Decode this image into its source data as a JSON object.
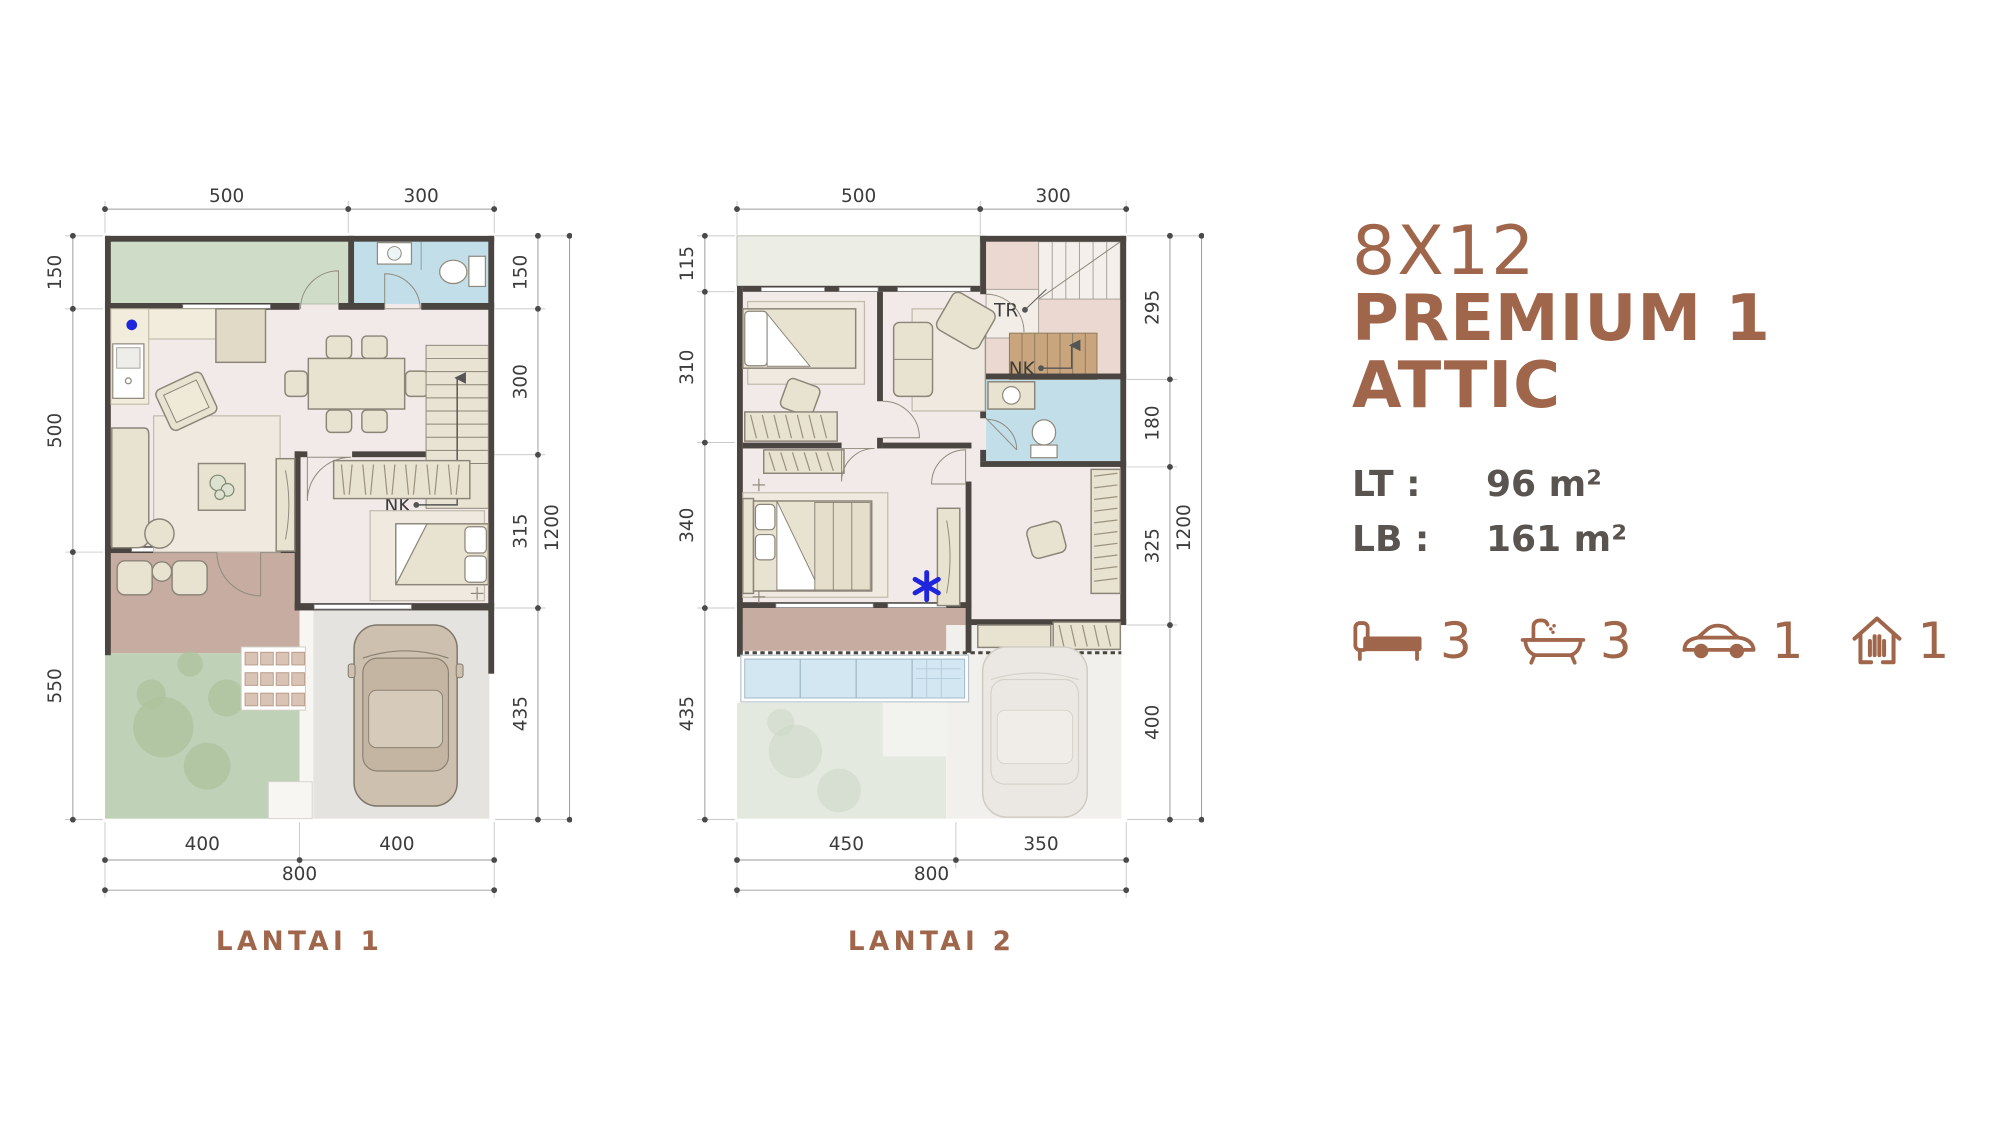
{
  "title": {
    "line1": "8X12",
    "line2": "PREMIUM 1 ATTIC"
  },
  "specs": {
    "rows": [
      {
        "label": "LT :",
        "value": "96 m²"
      },
      {
        "label": "LB :",
        "value": "161 m²"
      }
    ]
  },
  "features": {
    "items": [
      {
        "name": "bedrooms",
        "icon": "bed-icon",
        "count": "3"
      },
      {
        "name": "bathrooms",
        "icon": "bath-icon",
        "count": "3"
      },
      {
        "name": "carport",
        "icon": "car-icon",
        "count": "1"
      },
      {
        "name": "attic",
        "icon": "attic-icon",
        "count": "1"
      }
    ]
  },
  "floor1": {
    "label": "LANTAI 1",
    "dims": {
      "top": [
        "500",
        "300"
      ],
      "left": [
        "150",
        "500",
        "550"
      ],
      "right": [
        "150",
        "300",
        "315",
        "435"
      ],
      "right_total": "1200",
      "bottom": [
        "400",
        "400"
      ],
      "bottom_total": "800"
    },
    "annotations": {
      "stairs": "NK"
    }
  },
  "floor2": {
    "label": "LANTAI 2",
    "dims": {
      "top": [
        "500",
        "300"
      ],
      "left": [
        "115",
        "310",
        "340",
        "435"
      ],
      "right": [
        "295",
        "180",
        "325",
        "400"
      ],
      "right_total": "1200",
      "bottom": [
        "450",
        "350"
      ],
      "bottom_total": "800"
    },
    "annotations": {
      "attic_stairs": "TR",
      "stairs": "NK",
      "marker": "*"
    }
  },
  "colors": {
    "accent": "#A0664B",
    "text_dark": "#59544F",
    "dim_text": "#3C3C3C",
    "wall": "#4A4540",
    "floor": "#F2EAE8",
    "green_terrace": "#CEDCC8",
    "bath_blue": "#C2DFE9",
    "foyer_brown": "#C7ACA1",
    "garden": "#BFD1B6",
    "carport": "#E5E3E0",
    "furniture": "#E8E2D0",
    "furn_line": "#8B8478",
    "glass": "#D2E7F2",
    "marker_blue": "#1F25DD",
    "stair_pink": "#EAD8D1"
  }
}
